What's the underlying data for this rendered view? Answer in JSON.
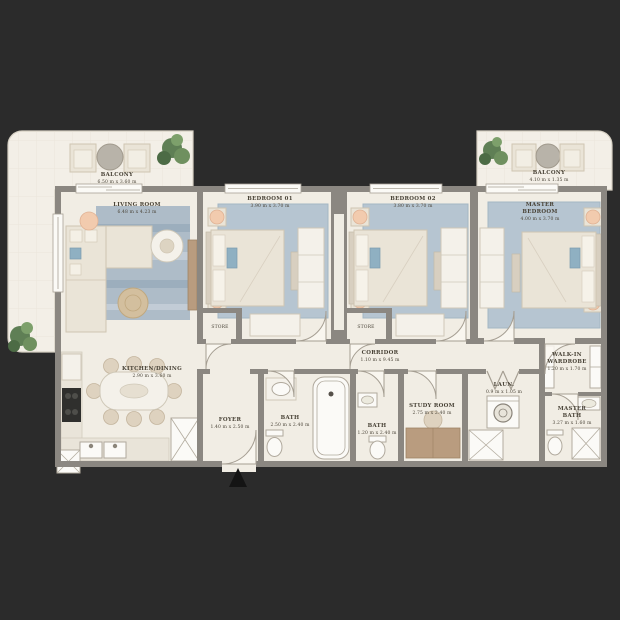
{
  "plan_type": "apartment-floor-plan",
  "rooms": {
    "balcony_left": {
      "name": "BALCONY",
      "dims": "6.50 m x 3.60 m"
    },
    "living": {
      "name": "LIVING ROOM",
      "dims": "6.48 m x 4.23 m"
    },
    "bedroom1": {
      "name": "BEDROOM 01",
      "dims": "3.90 m x 3.70 m"
    },
    "bedroom2": {
      "name": "BEDROOM 02",
      "dims": "3.80 m x 3.70 m"
    },
    "master_bedroom": {
      "name": "MASTER",
      "name2": "BEDROOM",
      "dims": "4.00 m x 3.70 m"
    },
    "balcony_right": {
      "name": "BALCONY",
      "dims": "4.10 m x 1.35 m"
    },
    "kitchen_dining": {
      "name": "KITCHEN/DINING",
      "dims": "2.90 m x 3.60 m"
    },
    "corridor": {
      "name": "CORRIDOR",
      "dims": "1.10 m x 9.45 m"
    },
    "foyer": {
      "name": "FOYER",
      "dims": "1.40 m x 2.50 m"
    },
    "bath1": {
      "name": "BATH",
      "dims": "2.50 m x 2.40 m"
    },
    "bath2": {
      "name": "BATH",
      "dims": "1.20 m x 2.40 m"
    },
    "study": {
      "name": "STUDY ROOM",
      "dims": "2.75 m x 2.40 m"
    },
    "walk_in_wardrobe": {
      "name": "WALK-IN",
      "name2": "WARDROBE",
      "dims": "1.20 m x 1.70 m"
    },
    "laundry": {
      "name": "LAUN.",
      "dims": "0.9 m x 1.05 m"
    },
    "master_bath": {
      "name": "MASTER",
      "name2": "BATH",
      "dims": "3.27 m x 1.60 m"
    },
    "store1": {
      "name": "STORE"
    },
    "store2": {
      "name": "STORE"
    }
  },
  "colors": {
    "background": "#2b2b2b",
    "floor": "#f1ede4",
    "walls": "#8b8781",
    "rug_blue": "#aebcc8",
    "bedroom_rug_blue": "#b6c5d1",
    "furniture_cream": "#eae4d7",
    "wood": "#b99c7f",
    "greenery": "#5f7f55",
    "lamp_peach": "#f2cbae",
    "appliance_dark": "#2f2f2d",
    "entry_arrow": "#141414"
  }
}
